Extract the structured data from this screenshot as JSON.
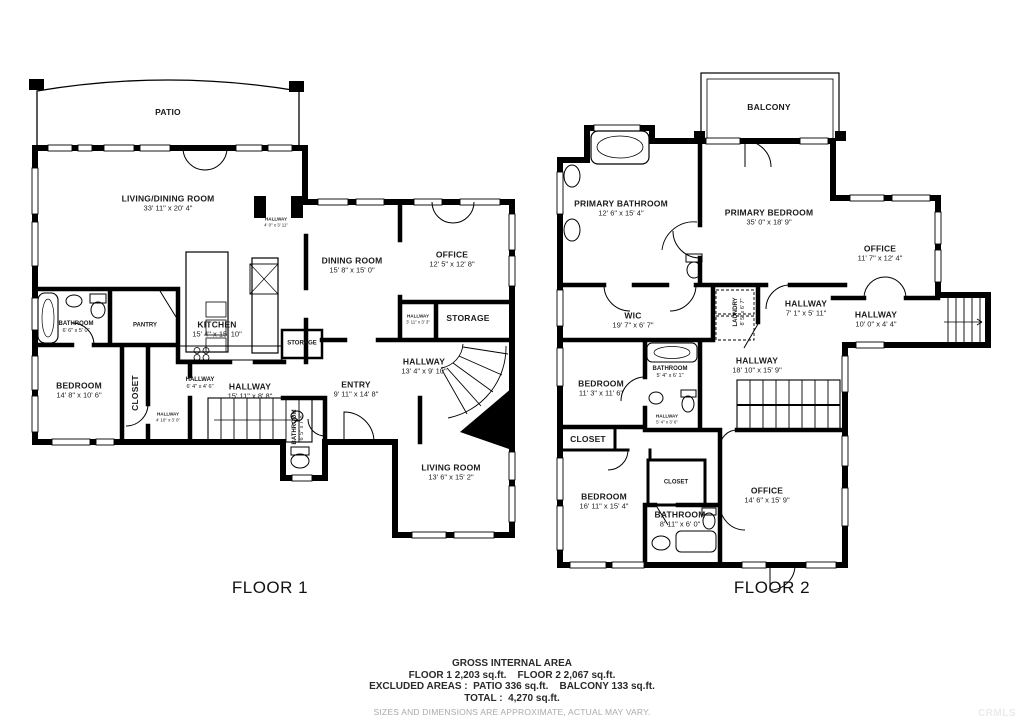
{
  "watermark": "CRMLS",
  "colors": {
    "wall": "#000000",
    "text": "#1b1b1b",
    "muted": "#aaaaaa",
    "watermark": "#ebebeb"
  },
  "floors": [
    {
      "label": "FLOOR 1",
      "rooms": [
        {
          "name": "PATIO",
          "dims": "",
          "x": 168,
          "y": 112,
          "size": "md"
        },
        {
          "name": "LIVING/DINING ROOM",
          "dims": "33' 11\" x 20' 4\"",
          "x": 168,
          "y": 203,
          "size": "md"
        },
        {
          "name": "HALLWAY",
          "dims": "4' 0\" x 3' 11\"",
          "x": 276,
          "y": 222,
          "size": "xs"
        },
        {
          "name": "DINING ROOM",
          "dims": "15' 8\" x 15' 0\"",
          "x": 352,
          "y": 265,
          "size": "md"
        },
        {
          "name": "OFFICE",
          "dims": "12' 5\" x 12' 8\"",
          "x": 452,
          "y": 259,
          "size": "md"
        },
        {
          "name": "KITCHEN",
          "dims": "15' 4\" x 15' 10\"",
          "x": 217,
          "y": 329,
          "size": "md"
        },
        {
          "name": "BATHROOM",
          "dims": "6' 6\" x 5' 0\"",
          "x": 76,
          "y": 328,
          "size": "sm"
        },
        {
          "name": "PANTRY",
          "dims": "",
          "x": 145,
          "y": 326,
          "size": "sm"
        },
        {
          "name": "STORAGE",
          "dims": "",
          "x": 468,
          "y": 318,
          "size": "md"
        },
        {
          "name": "STORAGE",
          "dims": "",
          "x": 302,
          "y": 344,
          "size": "sm"
        },
        {
          "name": "HALLWAY",
          "dims": "3' 11\" x 3' 3\"",
          "x": 418,
          "y": 319,
          "size": "xs"
        },
        {
          "name": "HALLWAY",
          "dims": "13' 4\" x 9' 10\"",
          "x": 424,
          "y": 366,
          "size": "md"
        },
        {
          "name": "BEDROOM",
          "dims": "14' 8\" x 10' 6\"",
          "x": 79,
          "y": 390,
          "size": "md"
        },
        {
          "name": "CLOSET",
          "dims": "",
          "x": 135,
          "y": 393,
          "size": "md",
          "vertical": true
        },
        {
          "name": "HALLWAY",
          "dims": "6' 4\" x 4' 6\"",
          "x": 200,
          "y": 384,
          "size": "sm"
        },
        {
          "name": "HALLWAY",
          "dims": "4' 10\" x 3' 0\"",
          "x": 168,
          "y": 417,
          "size": "xs"
        },
        {
          "name": "HALLWAY",
          "dims": "15' 11\" x 8' 8\"",
          "x": 250,
          "y": 391,
          "size": "md"
        },
        {
          "name": "ENTRY",
          "dims": "9' 11\" x 14' 8\"",
          "x": 356,
          "y": 389,
          "size": "md"
        },
        {
          "name": "BATHROOM",
          "dims": "6' 5\" x 7' 8\"",
          "x": 299,
          "y": 427,
          "size": "sm",
          "vertical": true
        },
        {
          "name": "LIVING ROOM",
          "dims": "13' 6\" x 15' 2\"",
          "x": 451,
          "y": 472,
          "size": "md"
        }
      ]
    },
    {
      "label": "FLOOR 2",
      "rooms": [
        {
          "name": "BALCONY",
          "dims": "",
          "x": 769,
          "y": 107,
          "size": "md"
        },
        {
          "name": "PRIMARY BATHROOM",
          "dims": "12' 6\" x 15' 4\"",
          "x": 621,
          "y": 208,
          "size": "md"
        },
        {
          "name": "PRIMARY BEDROOM",
          "dims": "35' 0\" x 18' 9\"",
          "x": 769,
          "y": 217,
          "size": "md"
        },
        {
          "name": "OFFICE",
          "dims": "11' 7\" x 12' 4\"",
          "x": 880,
          "y": 253,
          "size": "md"
        },
        {
          "name": "HALLWAY",
          "dims": "10' 0\" x 4' 4\"",
          "x": 876,
          "y": 319,
          "size": "md"
        },
        {
          "name": "WIC",
          "dims": "19' 7\" x 6' 7\"",
          "x": 633,
          "y": 320,
          "size": "md"
        },
        {
          "name": "LAUNDRY",
          "dims": "8' 5\" x 6' 7\"",
          "x": 740,
          "y": 312,
          "size": "sm",
          "vertical": true
        },
        {
          "name": "HALLWAY",
          "dims": "7' 1\" x 5' 11\"",
          "x": 806,
          "y": 308,
          "size": "md"
        },
        {
          "name": "HALLWAY",
          "dims": "18' 10\" x 15' 9\"",
          "x": 757,
          "y": 365,
          "size": "md"
        },
        {
          "name": "BEDROOM",
          "dims": "11' 3\" x 11' 6\"",
          "x": 601,
          "y": 388,
          "size": "md"
        },
        {
          "name": "BATHROOM",
          "dims": "5' 4\" x 6' 1\"",
          "x": 670,
          "y": 373,
          "size": "sm"
        },
        {
          "name": "HALLWAY",
          "dims": "5' 4\" x 3' 6\"",
          "x": 667,
          "y": 419,
          "size": "xs"
        },
        {
          "name": "CLOSET",
          "dims": "",
          "x": 588,
          "y": 439,
          "size": "md"
        },
        {
          "name": "CLOSET",
          "dims": "",
          "x": 676,
          "y": 483,
          "size": "sm"
        },
        {
          "name": "BEDROOM",
          "dims": "16' 11\" x 15' 4\"",
          "x": 604,
          "y": 501,
          "size": "md"
        },
        {
          "name": "BATHROOM",
          "dims": "8' 11\" x 6' 0\"",
          "x": 680,
          "y": 519,
          "size": "md"
        },
        {
          "name": "OFFICE",
          "dims": "14' 6\" x 15' 9\"",
          "x": 767,
          "y": 495,
          "size": "md"
        }
      ]
    }
  ],
  "footer": {
    "title": "GROSS INTERNAL AREA",
    "floors_line": "FLOOR 1 2,203 sq.ft.    FLOOR 2 2,067 sq.ft.",
    "excluded_line": "EXCLUDED AREAS :  PATIO 336 sq.ft.    BALCONY 133 sq.ft.",
    "total_line": "TOTAL :  4,270 sq.ft.",
    "disclaimer": "SIZES AND DIMENSIONS ARE APPROXIMATE, ACTUAL MAY VARY."
  }
}
